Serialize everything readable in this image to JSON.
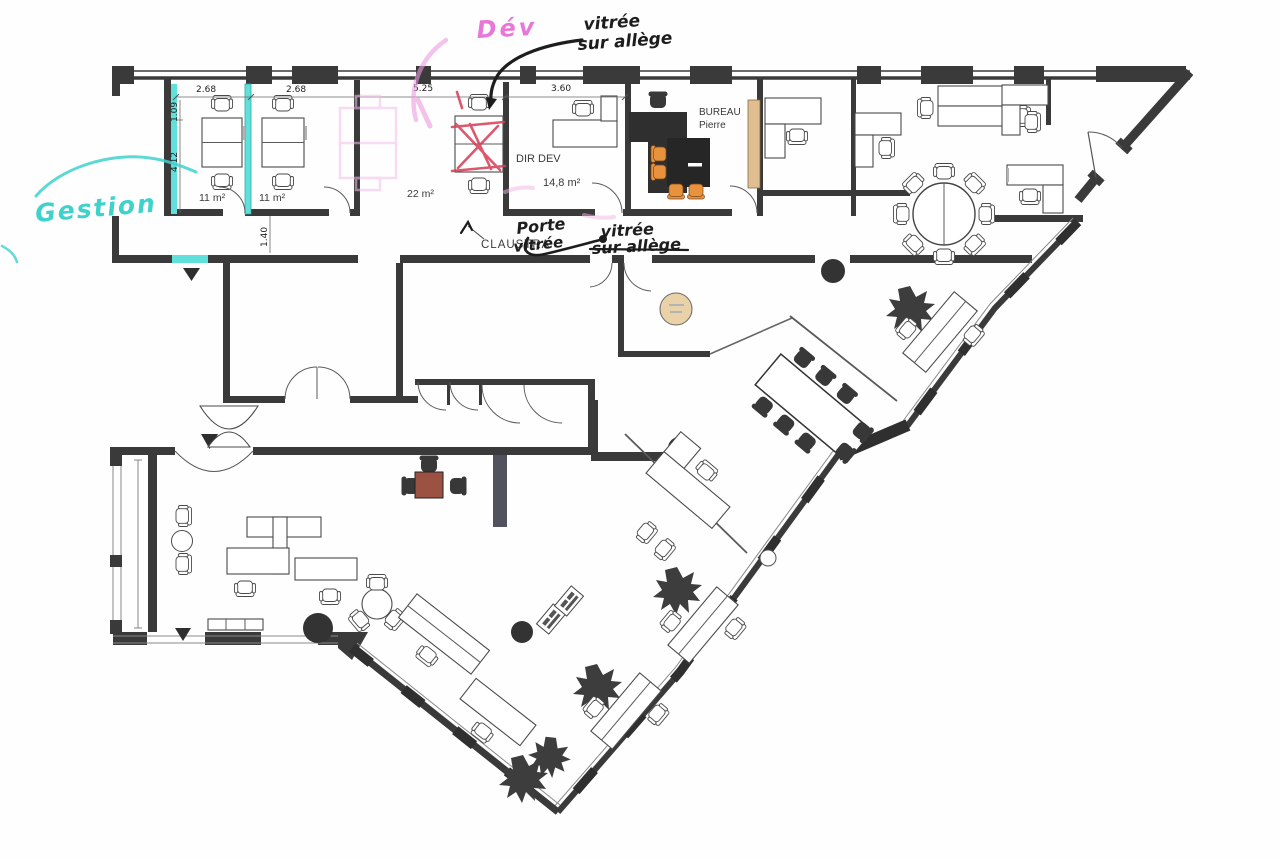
{
  "plan": {
    "handwriting": {
      "gestion": "Gestion",
      "dev": "Dév",
      "top_note_line1": "vitrée",
      "top_note_line2": "sur allège",
      "porte_line1": "Porte",
      "porte_line2": "vitrée",
      "mid_note_line1": "vitrée",
      "mid_note_line2": "sur allège"
    },
    "rooms": {
      "office1_area": "11 m²",
      "office2_area": "11 m²",
      "open_space_area": "22 m²",
      "dir_dev_name": "DIR DEV",
      "dir_dev_area": "14,8 m²",
      "bureau_title": "BUREAU",
      "bureau_occupant": "Pierre",
      "partition_label": "CLAUSTRA"
    },
    "dimensions": {
      "office1_width": "2.68",
      "office2_width": "2.68",
      "open_space_width": "5.25",
      "dir_dev_width": "3.60",
      "entry_depth": "1.09",
      "office_depth": "4.12",
      "corridor_depth": "1.40"
    },
    "colors": {
      "wall": "#3a3a3a",
      "highlight_cyan": "#5fe0db",
      "annotation_cyan": "#3fd2cd",
      "annotation_pink": "#e878d8",
      "annotation_pink_light": "#efb3e6",
      "annotation_red": "#d63c55",
      "annotation_ink": "#1d1d1d",
      "furniture_tan": "#dfbe92",
      "table_beige": "#e9d2a8",
      "chair_orange": "#e8923d",
      "table_brown": "#9c5243"
    }
  }
}
